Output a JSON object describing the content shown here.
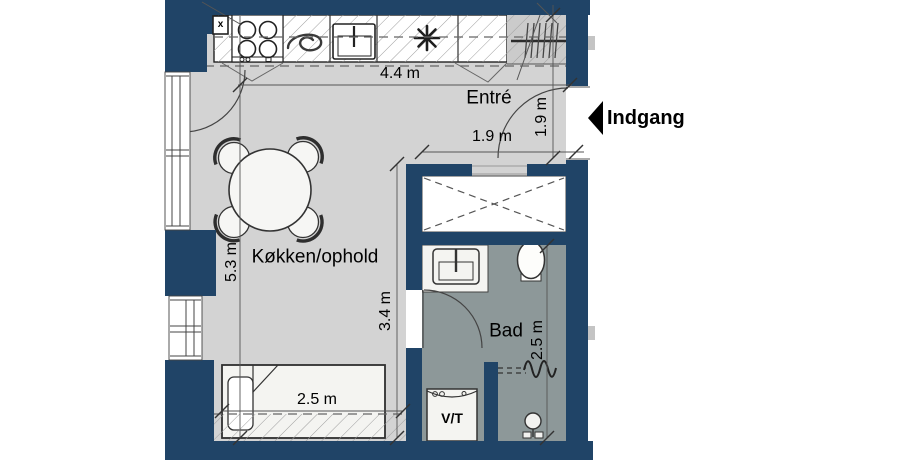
{
  "floorplan": {
    "rooms": {
      "kitchen_living": "Køkken/ophold",
      "entry": "Entré",
      "bath": "Bad"
    },
    "labels": {
      "entrance": "Indgang",
      "washer_dryer": "V/T",
      "electrical_panel": "x"
    },
    "dimensions": {
      "kitchen_width": "4.4 m",
      "entry_width": "1.9 m",
      "entry_depth": "1.9 m",
      "room_depth": "5.3 m",
      "inner_depth": "3.4 m",
      "bed_length": "2.5 m",
      "bath_depth": "2.5 m"
    },
    "colors": {
      "wall": "#204467",
      "floor": "#d3d3d3",
      "bath_floor": "#8d9899",
      "fixture": "#f4f4f1",
      "outline": "#333333",
      "page": "#ffffff"
    }
  }
}
